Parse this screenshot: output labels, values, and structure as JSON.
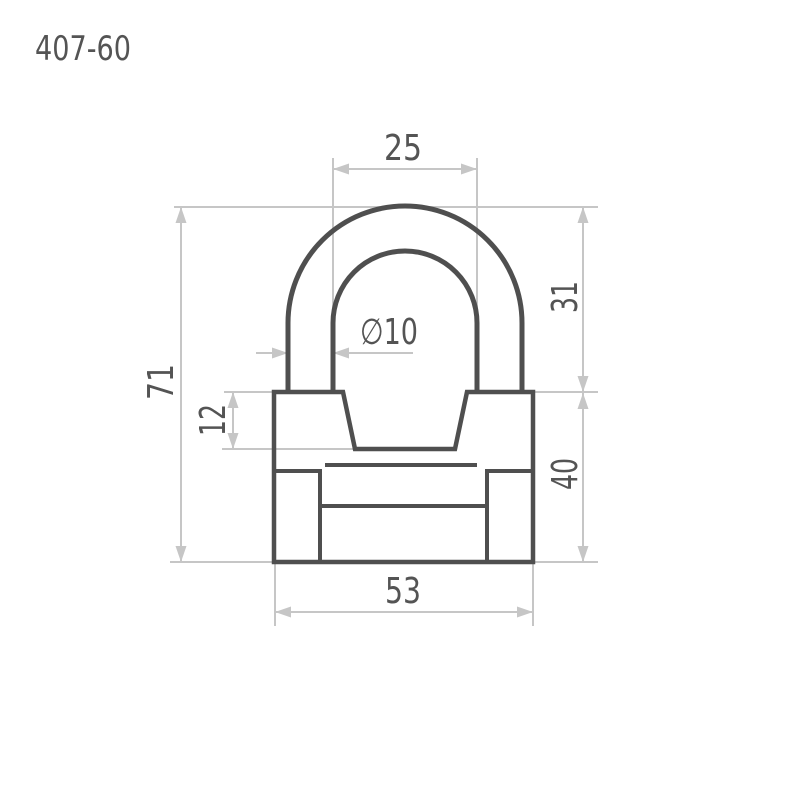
{
  "title": "407-60",
  "drawing": {
    "type": "technical-dimension-drawing",
    "subject": "padlock-front-view",
    "dimensions": {
      "shackle_inner_width": {
        "label": "25",
        "value": 25,
        "orientation": "horizontal"
      },
      "shackle_height": {
        "label": "31",
        "value": 31,
        "orientation": "vertical"
      },
      "overall_height": {
        "label": "71",
        "value": 71,
        "orientation": "vertical"
      },
      "shackle_diameter": {
        "label": "∅10",
        "value": 10,
        "orientation": "horizontal"
      },
      "body_step_depth": {
        "label": "12",
        "value": 12,
        "orientation": "vertical"
      },
      "body_height": {
        "label": "40",
        "value": 40,
        "orientation": "vertical"
      },
      "body_width": {
        "label": "53",
        "value": 53,
        "orientation": "horizontal"
      }
    }
  },
  "colors": {
    "part_line": "#4f4f4f",
    "dimension_line": "#c6c6c6",
    "text": "#545454",
    "background": "#ffffff"
  }
}
